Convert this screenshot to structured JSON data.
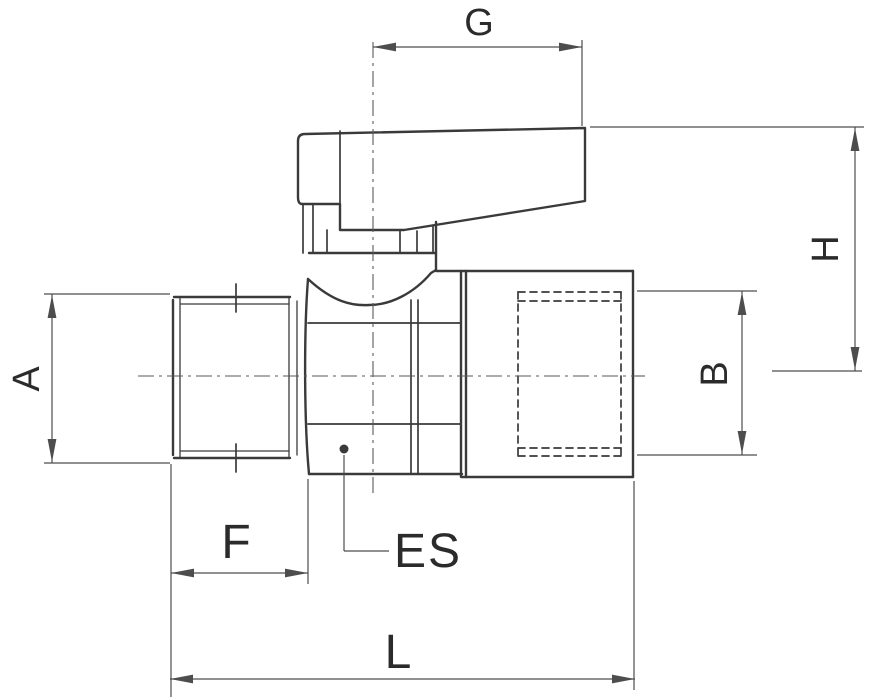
{
  "diagram": {
    "type": "technical-dimension-drawing",
    "subject": "Mini ball valve with lever handle, male x female threaded ends, side elevation with dimension callouts",
    "labels": {
      "g": "G",
      "h": "H",
      "a": "A",
      "b": "B",
      "f": "F",
      "es": "ES",
      "l": "L"
    },
    "colors": {
      "background": "#ffffff",
      "outline": "#3a3a3a",
      "dimension": "#4d4d4d",
      "text": "#2b2b2b"
    }
  }
}
